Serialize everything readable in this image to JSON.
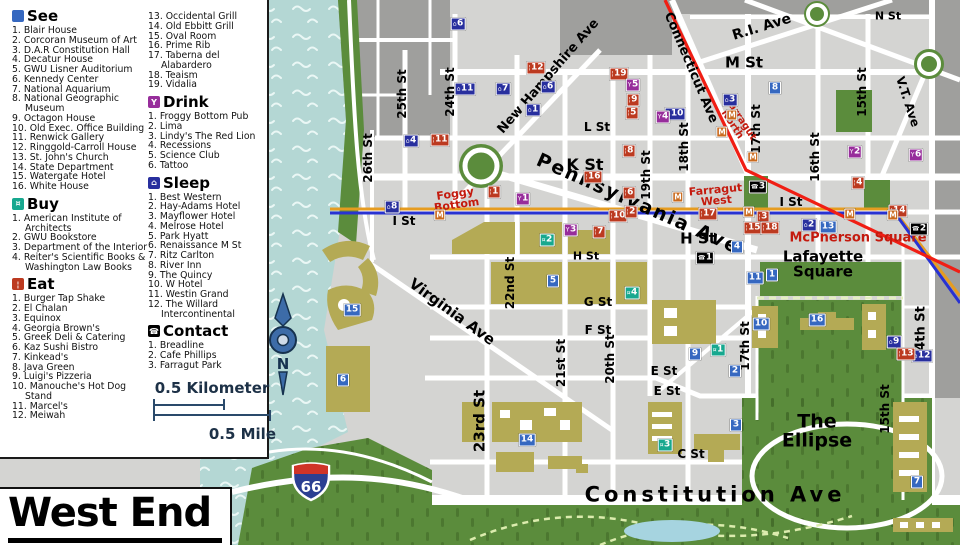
{
  "title": "West End",
  "compass": {
    "north_label": "N"
  },
  "shield": {
    "route": "66"
  },
  "colors": {
    "see": "#3668c0",
    "sleep": "#282f9e",
    "eat": "#bc3a20",
    "drink": "#972d9b",
    "buy": "#17a88f",
    "contact": "#000000",
    "metro": "#ca6a1e",
    "line_red": "#f01e14",
    "line_blue": "#2832d2",
    "line_orange": "#e69c20",
    "label_red": "#c41a0e",
    "park_green": "#5b8c3c",
    "river": "#b4d7d4",
    "building": "#b4aa55"
  },
  "legend": {
    "sections": {
      "see": {
        "label": "See",
        "items": [
          "Blair House",
          "Corcoran Museum of Art",
          "D.A.R Constitution Hall",
          "Decatur House",
          "GWU Lisner Auditorium",
          "Kennedy Center",
          "National Aquarium",
          "National Geographic Museum",
          "Octagon House",
          "Old Exec. Office Building",
          "Renwick Gallery",
          "Ringgold-Carroll House",
          "St. John's Church",
          "State Department",
          "Watergate Hotel",
          "White House"
        ]
      },
      "buy": {
        "label": "Buy",
        "items": [
          "American Institute of Architects",
          "GWU Bookstore",
          "Department of the Interior",
          "Reiter's Scientific Books & Washington Law Books"
        ]
      },
      "eat": {
        "label": "Eat",
        "items": [
          "Burger Tap Shake",
          "El Chalan",
          "Equinox",
          "Georgia Brown's",
          "Greek Deli & Catering",
          "Kaz Sushi Bistro",
          "Kinkead's",
          "Java Green",
          "Luigi's Pizzeria",
          "Manouche's Hot Dog Stand",
          "Marcel's",
          "Meiwah",
          "Occidental Grill",
          "Old Ebbitt Grill",
          "Oval Room",
          "Prime Rib",
          "Taberna del Alabardero",
          "Teaism",
          "Vidalia"
        ]
      },
      "drink": {
        "label": "Drink",
        "items": [
          "Froggy Bottom Pub",
          "Lima",
          "Lindy's The Red Lion",
          "Recessions",
          "Science Club",
          "Tattoo"
        ]
      },
      "sleep": {
        "label": "Sleep",
        "items": [
          "Best Western",
          "Hay-Adams Hotel",
          "Mayflower Hotel",
          "Melrose Hotel",
          "Park Hyatt",
          "Renaissance M St",
          "Ritz Carlton",
          "River Inn",
          "The Quincy",
          "W Hotel",
          "Westin Grand",
          "The Willard Intercontinental"
        ]
      },
      "contact": {
        "label": "Contact",
        "items": [
          "Breadline",
          "Cafe Phillips",
          "Farragut Park"
        ]
      }
    },
    "scale": {
      "km": "0.5 Kilometer",
      "mile": "0.5 Mile"
    }
  },
  "street_labels": [
    {
      "t": "N St",
      "x": 888,
      "y": 17,
      "s": 11
    },
    {
      "t": "M St",
      "x": 744,
      "y": 63,
      "s": 15
    },
    {
      "t": "R.I. Ave",
      "x": 762,
      "y": 28,
      "r": -17,
      "s": 14
    },
    {
      "t": "L St",
      "x": 597,
      "y": 128,
      "s": 12
    },
    {
      "t": "K St",
      "x": 585,
      "y": 165,
      "s": 16
    },
    {
      "t": "I St",
      "x": 404,
      "y": 222,
      "s": 12
    },
    {
      "t": "I St",
      "x": 791,
      "y": 203,
      "s": 12
    },
    {
      "t": "H St",
      "x": 586,
      "y": 257,
      "s": 11
    },
    {
      "t": "H St",
      "x": 698,
      "y": 239,
      "s": 15
    },
    {
      "t": "G St",
      "x": 598,
      "y": 303,
      "s": 12
    },
    {
      "t": "F St",
      "x": 598,
      "y": 331,
      "s": 12
    },
    {
      "t": "E St",
      "x": 664,
      "y": 372,
      "s": 12
    },
    {
      "t": "E St",
      "x": 667,
      "y": 392,
      "s": 12
    },
    {
      "t": "C St",
      "x": 691,
      "y": 455,
      "s": 12
    },
    {
      "t": "Constitution Ave",
      "x": 715,
      "y": 495,
      "s": 21,
      "ls": 4
    },
    {
      "t": "Virginia Ave",
      "x": 452,
      "y": 312,
      "r": 36,
      "s": 15
    },
    {
      "t": "Pennsylvania Ave",
      "x": 638,
      "y": 204,
      "r": 24,
      "s": 19,
      "ls": 2
    },
    {
      "t": "New Hampshire Ave",
      "x": 549,
      "y": 77,
      "r": -49,
      "s": 13
    },
    {
      "t": "Connecticut Ave",
      "x": 690,
      "y": 68,
      "r": 67,
      "s": 13
    },
    {
      "t": "V.T. Ave",
      "x": 907,
      "y": 102,
      "r": 72,
      "s": 12
    },
    {
      "t": "26th St",
      "x": 369,
      "y": 158,
      "r": -90,
      "s": 12
    },
    {
      "t": "25th St",
      "x": 403,
      "y": 94,
      "r": -90,
      "s": 12
    },
    {
      "t": "24th St",
      "x": 451,
      "y": 92,
      "r": -90,
      "s": 12
    },
    {
      "t": "23rd St",
      "x": 480,
      "y": 421,
      "r": -90,
      "s": 15
    },
    {
      "t": "22nd St",
      "x": 511,
      "y": 283,
      "r": -90,
      "s": 12
    },
    {
      "t": "21st St",
      "x": 562,
      "y": 363,
      "r": -90,
      "s": 12
    },
    {
      "t": "20th St",
      "x": 611,
      "y": 359,
      "r": -90,
      "s": 12
    },
    {
      "t": "19th St",
      "x": 647,
      "y": 175,
      "r": -90,
      "s": 12
    },
    {
      "t": "18th St",
      "x": 685,
      "y": 147,
      "r": -90,
      "s": 12
    },
    {
      "t": "17th St",
      "x": 757,
      "y": 129,
      "r": -90,
      "s": 12
    },
    {
      "t": "17th St",
      "x": 746,
      "y": 346,
      "r": -90,
      "s": 12
    },
    {
      "t": "16th St",
      "x": 816,
      "y": 157,
      "r": -90,
      "s": 12
    },
    {
      "t": "15th St",
      "x": 863,
      "y": 92,
      "r": -90,
      "s": 12
    },
    {
      "t": "15th St",
      "x": 886,
      "y": 409,
      "r": -90,
      "s": 12
    },
    {
      "t": "14th St",
      "x": 922,
      "y": 333,
      "r": -90,
      "s": 13
    },
    {
      "t": "Foggy\nBottom",
      "x": 456,
      "y": 200,
      "r": -8,
      "s": 11,
      "c": "#c41a0e"
    },
    {
      "t": "Farragut\nNorth",
      "x": 736,
      "y": 122,
      "r": 57,
      "s": 10,
      "c": "#c41a0e"
    },
    {
      "t": "Farragut\nWest",
      "x": 716,
      "y": 196,
      "r": -5,
      "s": 11,
      "c": "#c41a0e"
    },
    {
      "t": "McPherson Square",
      "x": 858,
      "y": 239,
      "s": 13,
      "c": "#c41a0e"
    },
    {
      "t": "Lafayette\nSquare",
      "x": 823,
      "y": 264,
      "s": 15
    },
    {
      "t": "The\nEllipse",
      "x": 817,
      "y": 431,
      "s": 19
    }
  ],
  "markers": [
    {
      "type": "sleep",
      "n": "6",
      "x": 458,
      "y": 24
    },
    {
      "type": "sleep",
      "n": "11",
      "x": 465,
      "y": 89
    },
    {
      "type": "sleep",
      "n": "7",
      "x": 503,
      "y": 89
    },
    {
      "type": "sleep",
      "n": "6",
      "x": 548,
      "y": 87
    },
    {
      "type": "sleep",
      "n": "1",
      "x": 533,
      "y": 110
    },
    {
      "type": "sleep",
      "n": "4",
      "x": 411,
      "y": 141
    },
    {
      "type": "sleep",
      "n": "8",
      "x": 392,
      "y": 207
    },
    {
      "type": "sleep",
      "n": "3",
      "x": 730,
      "y": 100
    },
    {
      "type": "sleep",
      "n": "10",
      "x": 675,
      "y": 114
    },
    {
      "type": "sleep",
      "n": "2",
      "x": 809,
      "y": 225
    },
    {
      "type": "sleep",
      "n": "9",
      "x": 894,
      "y": 342
    },
    {
      "type": "sleep",
      "n": "12",
      "x": 922,
      "y": 356
    },
    {
      "type": "see",
      "n": "8",
      "x": 775,
      "y": 88
    },
    {
      "type": "see",
      "n": "15",
      "x": 352,
      "y": 310
    },
    {
      "type": "see",
      "n": "6",
      "x": 343,
      "y": 380
    },
    {
      "type": "see",
      "n": "5",
      "x": 553,
      "y": 281
    },
    {
      "type": "see",
      "n": "14",
      "x": 527,
      "y": 440
    },
    {
      "type": "see",
      "n": "11",
      "x": 755,
      "y": 278
    },
    {
      "type": "see",
      "n": "1",
      "x": 772,
      "y": 275
    },
    {
      "type": "see",
      "n": "10",
      "x": 761,
      "y": 324
    },
    {
      "type": "see",
      "n": "16",
      "x": 817,
      "y": 320
    },
    {
      "type": "see",
      "n": "9",
      "x": 695,
      "y": 354
    },
    {
      "type": "see",
      "n": "2",
      "x": 735,
      "y": 371
    },
    {
      "type": "see",
      "n": "3",
      "x": 736,
      "y": 425
    },
    {
      "type": "see",
      "n": "7",
      "x": 917,
      "y": 482
    },
    {
      "type": "see",
      "n": "13",
      "x": 828,
      "y": 227
    },
    {
      "type": "see",
      "n": "4",
      "x": 737,
      "y": 247
    },
    {
      "type": "eat",
      "n": "12",
      "x": 536,
      "y": 68
    },
    {
      "type": "eat",
      "n": "19",
      "x": 619,
      "y": 74
    },
    {
      "type": "eat",
      "n": "9",
      "x": 633,
      "y": 100
    },
    {
      "type": "eat",
      "n": "5",
      "x": 632,
      "y": 113
    },
    {
      "type": "eat",
      "n": "11",
      "x": 440,
      "y": 140
    },
    {
      "type": "eat",
      "n": "8",
      "x": 629,
      "y": 151
    },
    {
      "type": "eat",
      "n": "16",
      "x": 593,
      "y": 177
    },
    {
      "type": "eat",
      "n": "6",
      "x": 629,
      "y": 193
    },
    {
      "type": "eat",
      "n": "1",
      "x": 494,
      "y": 192
    },
    {
      "type": "eat",
      "n": "10",
      "x": 618,
      "y": 216
    },
    {
      "type": "eat",
      "n": "2",
      "x": 631,
      "y": 212
    },
    {
      "type": "eat",
      "n": "7",
      "x": 599,
      "y": 232
    },
    {
      "type": "eat",
      "n": "17",
      "x": 708,
      "y": 214
    },
    {
      "type": "eat",
      "n": "3",
      "x": 763,
      "y": 217
    },
    {
      "type": "eat",
      "n": "15",
      "x": 753,
      "y": 228
    },
    {
      "type": "eat",
      "n": "18",
      "x": 770,
      "y": 228
    },
    {
      "type": "eat",
      "n": "4",
      "x": 858,
      "y": 183
    },
    {
      "type": "eat",
      "n": "14",
      "x": 898,
      "y": 211
    },
    {
      "type": "eat",
      "n": "13",
      "x": 906,
      "y": 354
    },
    {
      "type": "drink",
      "n": "5",
      "x": 633,
      "y": 85
    },
    {
      "type": "drink",
      "n": "4",
      "x": 663,
      "y": 117
    },
    {
      "type": "drink",
      "n": "1",
      "x": 523,
      "y": 199
    },
    {
      "type": "drink",
      "n": "3",
      "x": 571,
      "y": 230
    },
    {
      "type": "drink",
      "n": "2",
      "x": 855,
      "y": 152
    },
    {
      "type": "drink",
      "n": "6",
      "x": 916,
      "y": 155
    },
    {
      "type": "buy",
      "n": "2",
      "x": 547,
      "y": 240
    },
    {
      "type": "buy",
      "n": "4",
      "x": 632,
      "y": 293
    },
    {
      "type": "buy",
      "n": "1",
      "x": 718,
      "y": 350
    },
    {
      "type": "buy",
      "n": "3",
      "x": 665,
      "y": 445
    },
    {
      "type": "contact",
      "n": "3",
      "x": 758,
      "y": 187
    },
    {
      "type": "contact",
      "n": "1",
      "x": 705,
      "y": 258
    },
    {
      "type": "contact",
      "n": "2",
      "x": 919,
      "y": 229
    }
  ],
  "metro_stations": [
    {
      "x": 440,
      "y": 215
    },
    {
      "x": 678,
      "y": 197
    },
    {
      "x": 749,
      "y": 212
    },
    {
      "x": 732,
      "y": 115
    },
    {
      "x": 722,
      "y": 132
    },
    {
      "x": 753,
      "y": 157
    },
    {
      "x": 850,
      "y": 214
    },
    {
      "x": 893,
      "y": 215
    }
  ]
}
